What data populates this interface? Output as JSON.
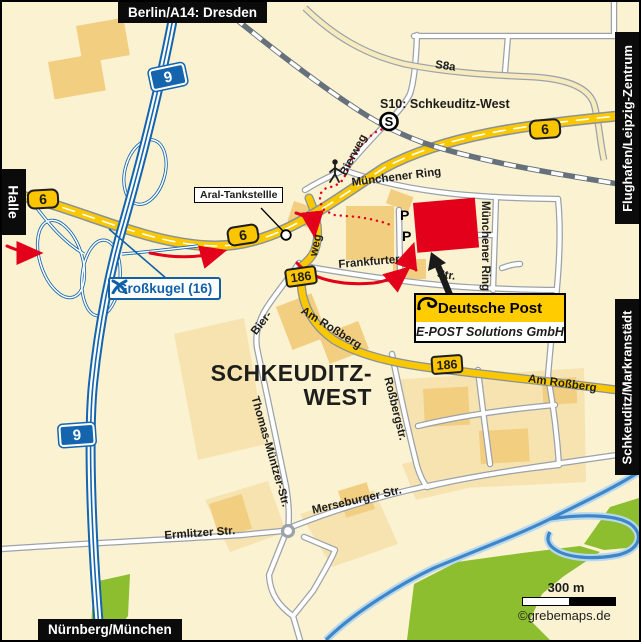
{
  "map": {
    "edge_labels": {
      "top": "Berlin/A14: Dresden",
      "left": "Halle",
      "right_top": "Flughafen/Leipzig-Zentrum",
      "right_bottom": "Schkeuditz/Markranstädt",
      "bottom": "Nürnberg/München"
    },
    "badges": {
      "a9": "9",
      "b6": "6",
      "b186": "186"
    },
    "station": {
      "symbol": "S",
      "label": "S10: Schkeuditz-West"
    },
    "streets": {
      "s8a": "S8a",
      "bierweg": "Bierweg",
      "muenchener_ring": "Münchener Ring",
      "frankfurter": "Frankfurter",
      "str_suffix": "Str.",
      "weg": "weg",
      "bier_prefix": "Bier-",
      "am_rossberg": "Am Roßberg",
      "thomas_muentzer": "Thomas-Müntzer-Str.",
      "rossbergstr": "Roßbergstr.",
      "merseburger": "Merseburger Str.",
      "ermlitzer": "Ermlitzer Str."
    },
    "callouts": {
      "aral": "Aral-Tankstellle",
      "grosskugel": "Großkugel (16)"
    },
    "destination": {
      "company_line1": "Deutsche Post",
      "company_line2": "E-POST Solutions GmbH",
      "parking": "P"
    },
    "district": {
      "line1": "SCHKEUDITZ-",
      "line2": "WEST"
    },
    "scale": {
      "distance": "300 m",
      "credit": "©grebemaps.de"
    },
    "colors": {
      "background": "#FBF2D2",
      "post_yellow": "#FFCC00",
      "post_red": "#E2001A",
      "motorway_blue": "#1565AE",
      "road_yellow": "#FAC800",
      "green_area": "#8CBE2F",
      "water": "#3E86C6",
      "grosskugel_blue": "#1060A8"
    }
  }
}
